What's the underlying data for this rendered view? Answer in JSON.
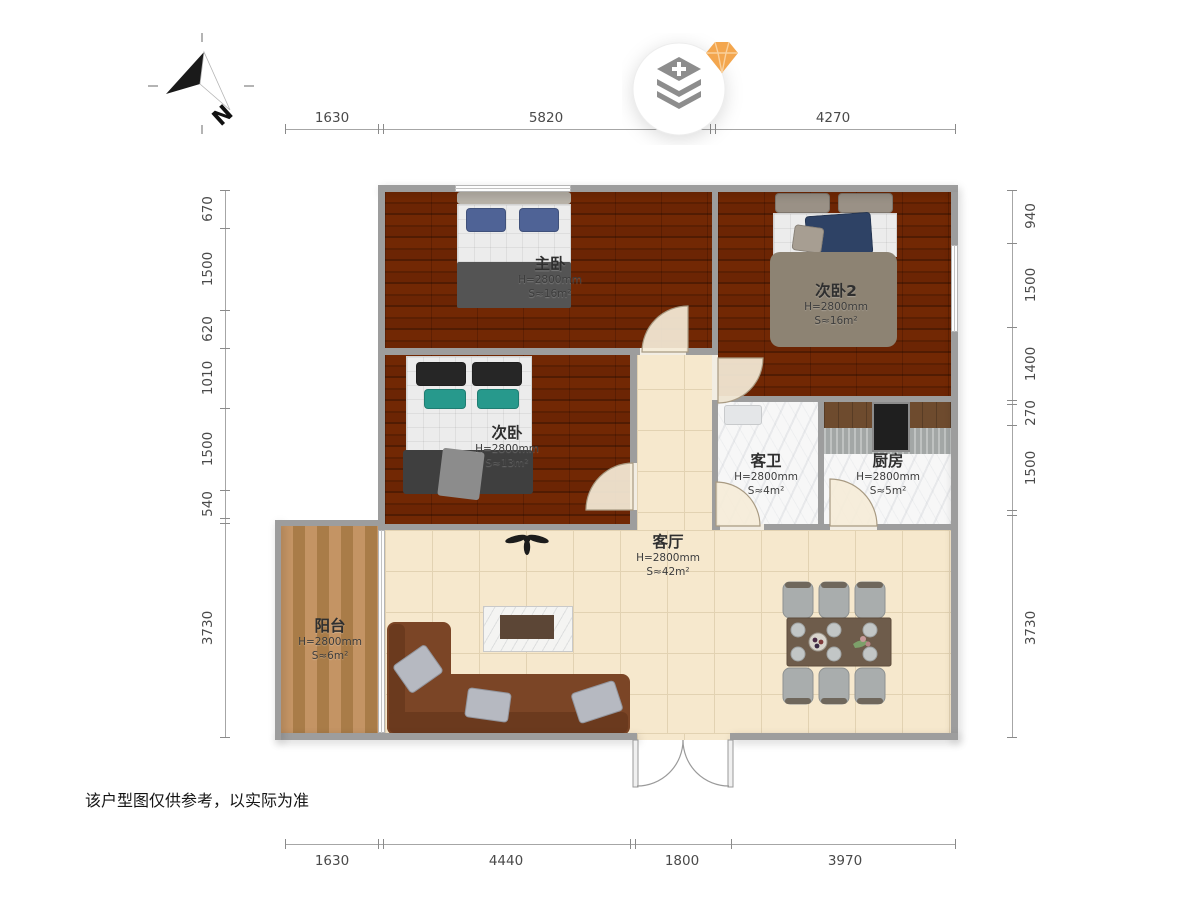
{
  "compass": {
    "label": "N",
    "icon": "compass-north-icon"
  },
  "watermark": {
    "icon": "layers-add-icon",
    "gem_icon": "diamond-gem-icon"
  },
  "rooms": [
    {
      "id": "master",
      "name": "主卧",
      "height": "H=2800mm",
      "area": "S≈16m²"
    },
    {
      "id": "bedroom2",
      "name": "次卧2",
      "height": "H=2800mm",
      "area": "S≈16m²"
    },
    {
      "id": "bedroom",
      "name": "次卧",
      "height": "H=2800mm",
      "area": "S≈13m²"
    },
    {
      "id": "bathroom",
      "name": "客卫",
      "height": "H=2800mm",
      "area": "S≈4m²"
    },
    {
      "id": "kitchen",
      "name": "厨房",
      "height": "H=2800mm",
      "area": "S≈5m²"
    },
    {
      "id": "living",
      "name": "客厅",
      "height": "H=2800mm",
      "area": "S≈42m²"
    },
    {
      "id": "balcony",
      "name": "阳台",
      "height": "H=2800mm",
      "area": "S≈6m²"
    }
  ],
  "dimensions": {
    "top": [
      "1630",
      "5820",
      "4270"
    ],
    "bottom": [
      "1630",
      "4440",
      "1800",
      "3970"
    ],
    "left": [
      "670",
      "1500",
      "620",
      "1010",
      "1500",
      "540",
      "3730"
    ],
    "right": [
      "940",
      "1500",
      "1400",
      "270",
      "1500",
      "3730"
    ]
  },
  "disclaimer": "该户型图仅供参考，以实际为准",
  "icons": {
    "fan": "ceiling-fan-icon"
  },
  "colors": {
    "wood_floor": "#a4611f",
    "balcony_floor": "#b98c5a",
    "tile_floor": "#f6e8cd",
    "marble_floor": "#f7f7f7",
    "wall": "#9d9d9d",
    "gem_accent": "#f3a64e",
    "sofa": "#7b4526",
    "duvet_grey": "#8d8373",
    "pillow_navy": "#4f6396",
    "pillow_teal": "#27998c"
  }
}
